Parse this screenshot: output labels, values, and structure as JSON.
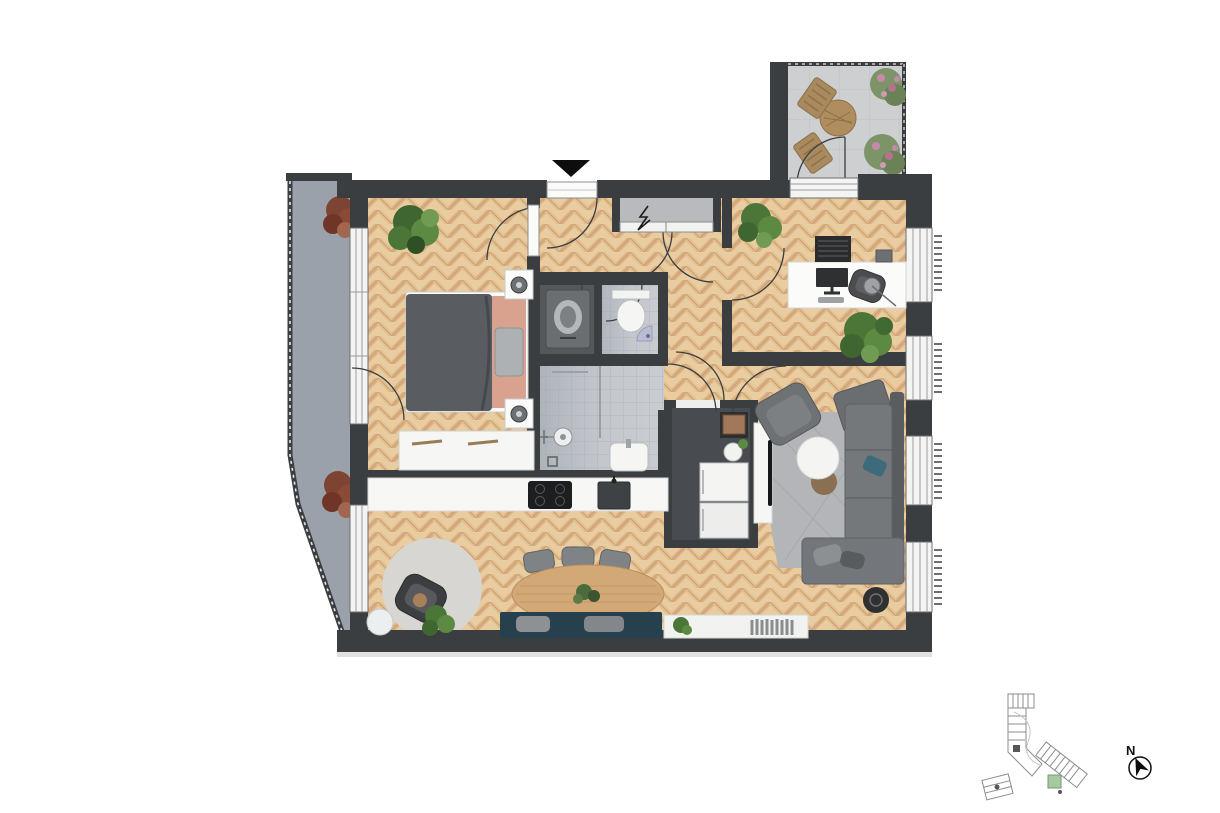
{
  "plan": {
    "type": "apartment-floor-plan-top-view",
    "compass": {
      "label": "N"
    },
    "icons": {
      "entry_marker": "entry-arrow-down",
      "electrical_panel": "lightning-zigzag",
      "north_compass": "compass-needle"
    },
    "rooms": [
      "bedroom",
      "hallway",
      "wardrobe-closet",
      "utility-room",
      "wc",
      "bathroom",
      "office",
      "kitchen",
      "pantry",
      "living-room",
      "dining-area",
      "terrace-top",
      "balcony-left"
    ],
    "palette": {
      "wall": "#3b3e41",
      "wood-light": "#e9cda1",
      "wood-mid": "#dcb184",
      "wood-dark": "#c9a06f",
      "tile": "#c9cdd2",
      "tile-line": "#b4b8be",
      "balcony-left": "#9aa1ab",
      "terrace-top": "#cdcfd1",
      "rug": "#b3b5b8",
      "rug-round": "#d8d6d2",
      "sofa": "#75787b",
      "sofa-dark": "#5a5d60",
      "bench-teal": "#27404d",
      "bed-duvet": "#595c60",
      "bed-sheet": "#d8a28e",
      "table-wood": "#d2a876",
      "counter-white": "#f7f7f5",
      "appliance-black": "#1d1e20",
      "plant-green": "#5d8a43",
      "plant-dark": "#3f6630",
      "bush-red": "#7e4433",
      "flower-pink": "#c789a8",
      "unit-green": "#a8c8a4"
    }
  }
}
